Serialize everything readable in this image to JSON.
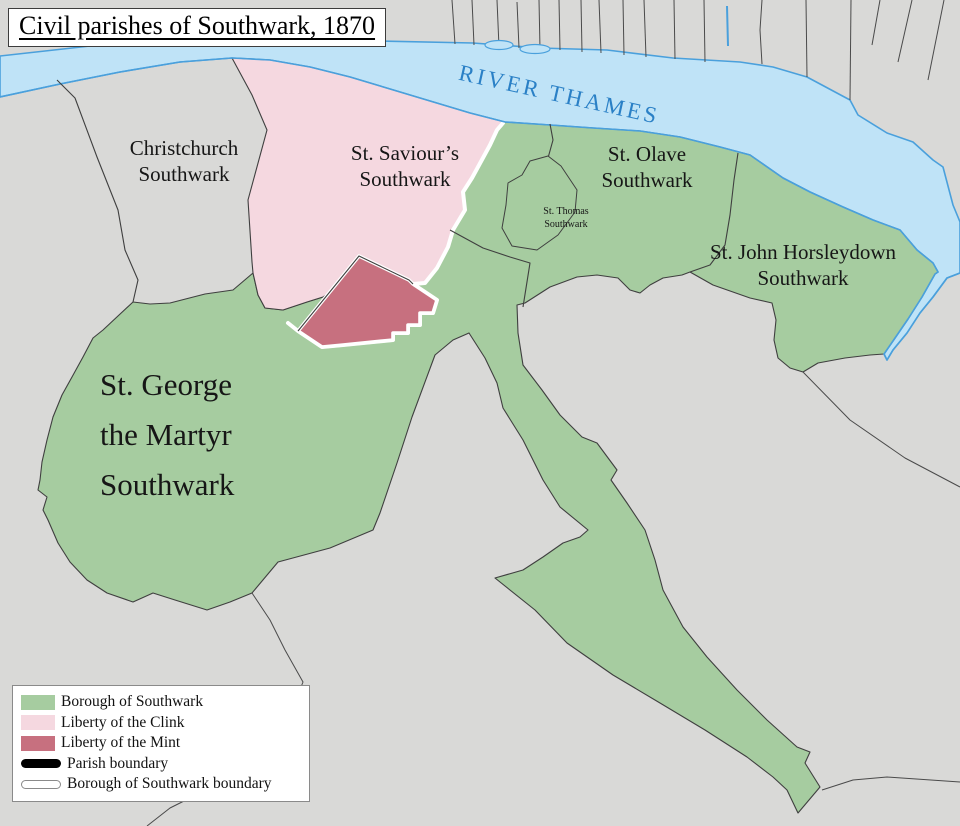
{
  "title": "Civil parishes of Southwark, 1870",
  "river": {
    "label": "RIVER THAMES"
  },
  "parishes": [
    {
      "id": "christchurch",
      "lines": [
        "Christchurch",
        "Southwark"
      ]
    },
    {
      "id": "st-saviours",
      "lines": [
        "St. Saviour’s",
        "Southwark"
      ]
    },
    {
      "id": "st-olave",
      "lines": [
        "St. Olave",
        "Southwark"
      ]
    },
    {
      "id": "st-thomas",
      "lines": [
        "St. Thomas",
        "Southwark"
      ]
    },
    {
      "id": "st-john-horsleydown",
      "lines": [
        "St. John Horsleydown",
        "Southwark"
      ]
    },
    {
      "id": "st-george-the-martyr",
      "lines": [
        "St. George",
        "the Martyr",
        "Southwark"
      ]
    }
  ],
  "legend": {
    "items": [
      {
        "label": "Borough of Southwark",
        "swatch": "green-fill"
      },
      {
        "label": "Liberty of the Clink",
        "swatch": "pink-fill"
      },
      {
        "label": "Liberty of the Mint",
        "swatch": "rose-fill"
      },
      {
        "label": "Parish boundary",
        "swatch": "black-line"
      },
      {
        "label": "Borough of Southwark boundary",
        "swatch": "white-line"
      }
    ]
  },
  "colors": {
    "borough_green": "#a6cca0",
    "clink_pink": "#f5d8e0",
    "mint_rose": "#c7707f",
    "river_fill": "#bfe3f7",
    "river_stroke": "#4aa0dc",
    "land_gray": "#d9d9d7",
    "parish_boundary_dark": "#3f3f3f",
    "borough_boundary_white": "#ffffff",
    "river_label_blue": "#2a80c6"
  }
}
